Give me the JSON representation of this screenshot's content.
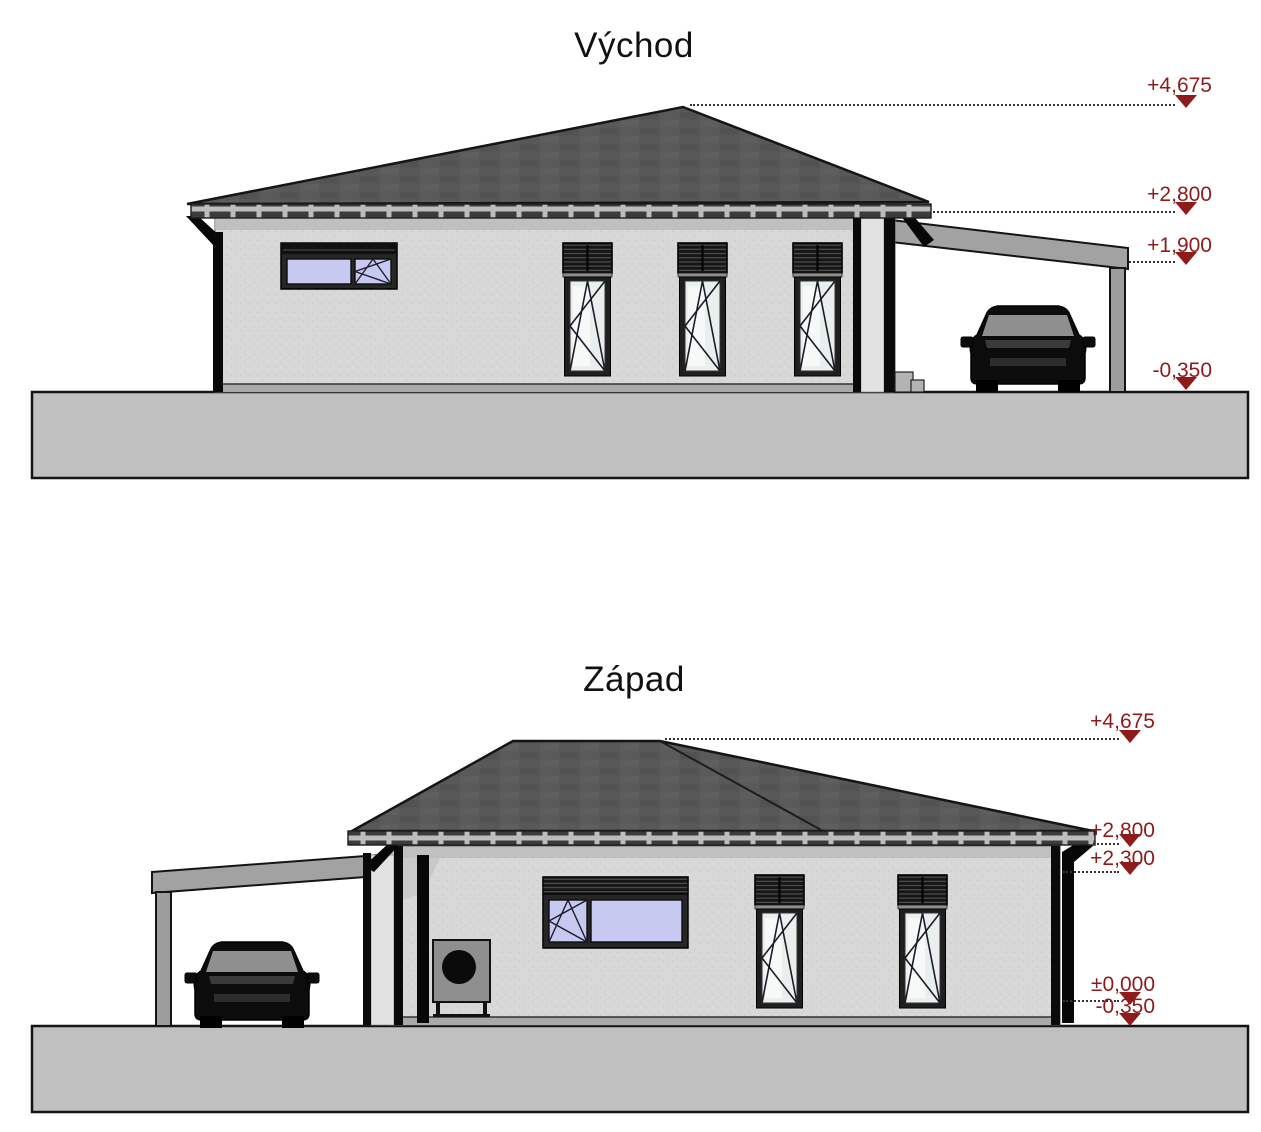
{
  "colors": {
    "marker_red": "#8e1b1b",
    "roof_gray": "#575757",
    "wall_gray": "#d8d8d8",
    "ground_gray": "#c0c0c0",
    "glass_tinted": "#c7c9f0",
    "glass_clear": "#e9efed"
  },
  "elevations": [
    {
      "title": "Východ",
      "markers": [
        {
          "label": "+4,675"
        },
        {
          "label": "+2,800"
        },
        {
          "label": "+1,900"
        },
        {
          "label": "-0,350"
        }
      ]
    },
    {
      "title": "Západ",
      "markers": [
        {
          "label": "+4,675"
        },
        {
          "label": "+2,800"
        },
        {
          "label": "+2,300"
        },
        {
          "label": "±0,000"
        },
        {
          "label": "-0,350"
        }
      ]
    }
  ]
}
